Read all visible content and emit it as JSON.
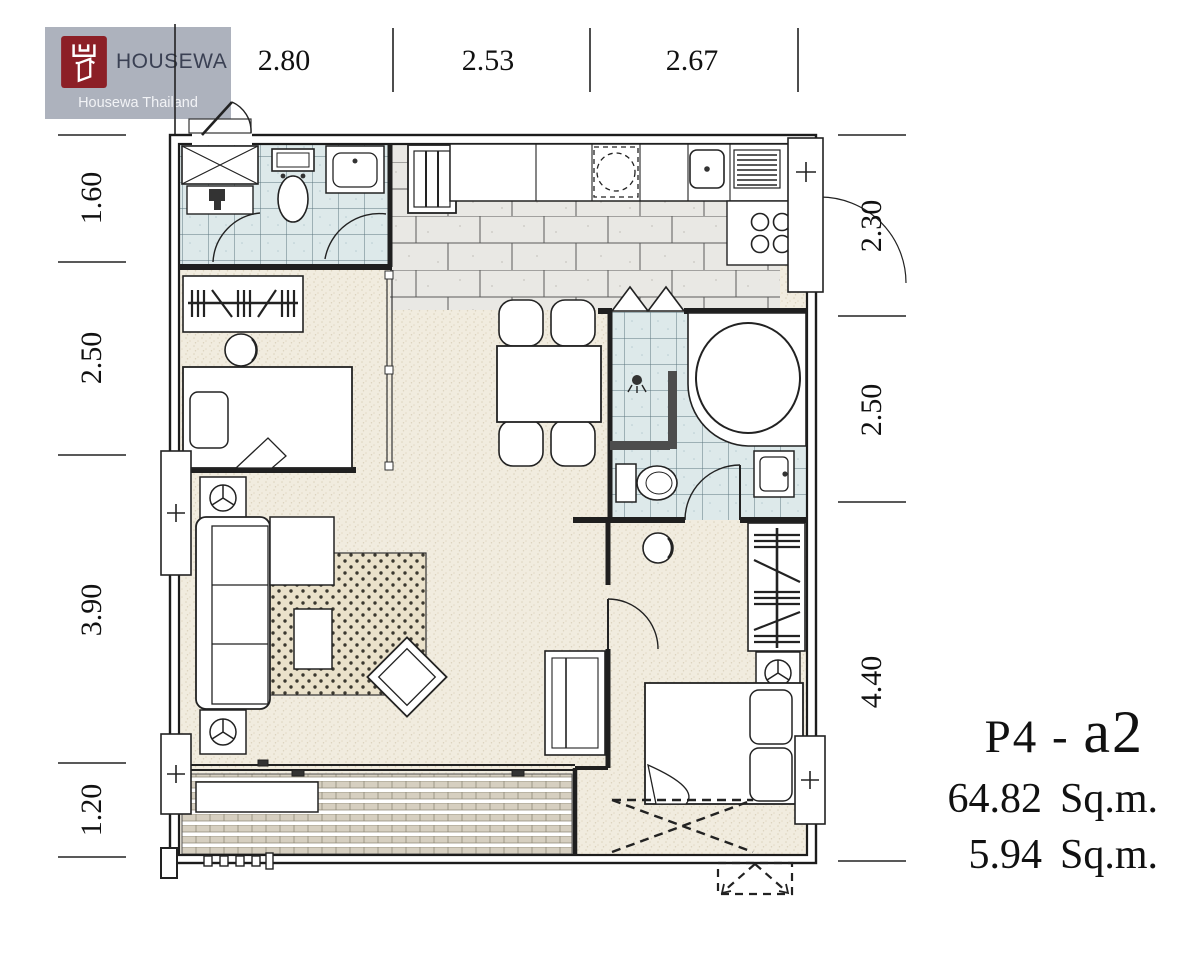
{
  "logo": {
    "brand": "HOUSEWA",
    "subtitle": "Housewa Thailand",
    "bg_color": "#adb2bd",
    "mark_color": "#8c1f26",
    "brand_color": "#3a4053",
    "subtitle_color": "#f2f3f6"
  },
  "dimensions": {
    "top": [
      "2.80",
      "2.53",
      "2.67"
    ],
    "left": [
      "1.60",
      "2.50",
      "3.90",
      "1.20"
    ],
    "right": [
      "2.30",
      "2.50",
      "4.40"
    ]
  },
  "unit_label": {
    "code_prefix": "P4 - ",
    "code_suffix": "a2",
    "area_interior": "64.82",
    "area_interior_unit": "Sq.m.",
    "area_balcony": "5.94",
    "area_balcony_unit": "Sq.m."
  }
}
